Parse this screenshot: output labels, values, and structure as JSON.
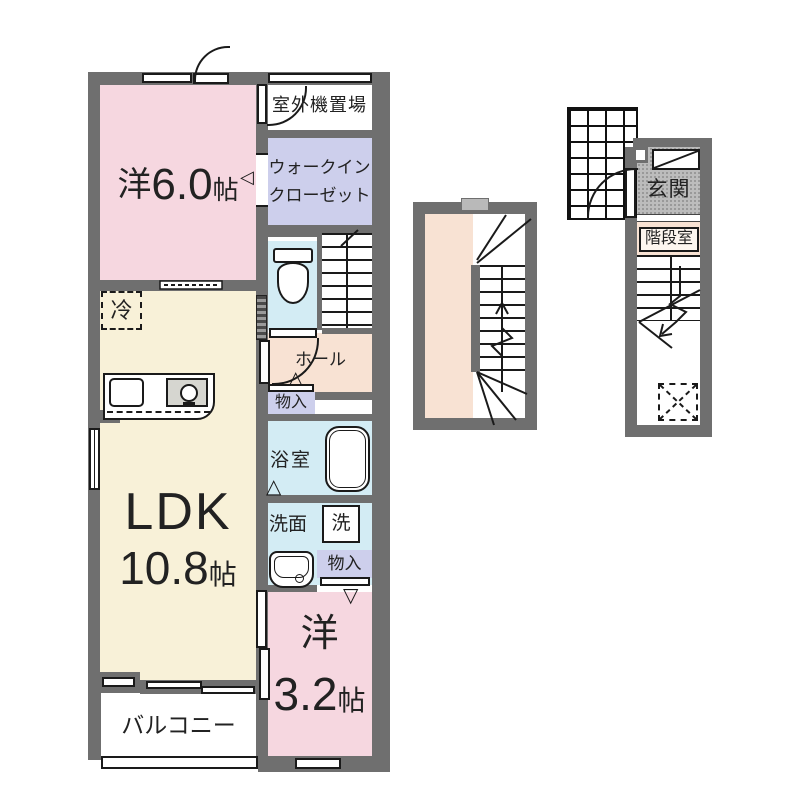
{
  "plan": {
    "rooms": {
      "western6": {
        "prefix": "洋",
        "value": "6.0",
        "unit": "帖"
      },
      "outdoor_unit": "室外機置場",
      "wic_line1": "ウォークイン",
      "wic_line2": "クローゼット",
      "fridge": "冷",
      "hall": "ホール",
      "storage_hall": "物入",
      "bath": "浴室",
      "washroom": "洗面",
      "washer": "洗",
      "storage_washroom": "物入",
      "ldk_name": "LDK",
      "ldk_size": "10.8",
      "ldk_unit": "帖",
      "western3": {
        "prefix": "洋",
        "value": "3.2",
        "unit": "帖"
      },
      "balcony": "バルコニー",
      "entrance": "玄関",
      "stairwell": "階段室"
    },
    "symbols": {
      "door_swing_up": "△",
      "door_swing_down": "▽",
      "door_swing_left": "◁"
    },
    "colors": {
      "wall": "#6f6f6f",
      "western_room_pink": "#f6d7e0",
      "ldk_cream": "#f8f1d8",
      "hall_peach": "#f8e2d3",
      "closet_lavender": "#cdcfec",
      "wet_area_blue": "#d3ecf4",
      "entrance_gray": "#bcbcbc",
      "line": "#1a1a1a"
    }
  }
}
